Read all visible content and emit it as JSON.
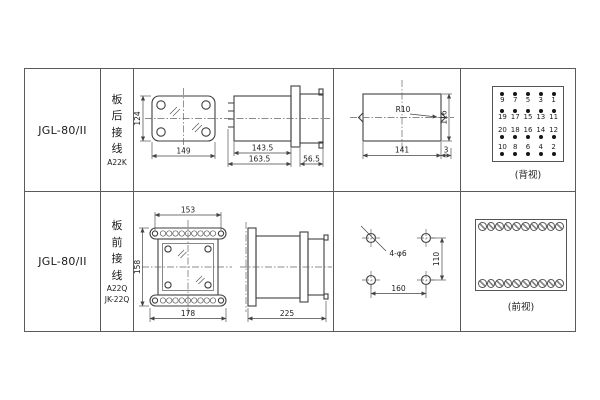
{
  "table": {
    "rows": [
      {
        "model": "JGL-80/II",
        "wiring_chars": "板后接线",
        "wiring_codes": [
          "A22K"
        ],
        "front_view": {
          "height_dim": "124",
          "width_dim": "149"
        },
        "side_view": {
          "body_dim": "143.5",
          "total_dim": "163.5",
          "rear_dim": "56.5"
        },
        "cutout_view": {
          "radius_label": "R10",
          "width_dim": "141",
          "height_dim": "116",
          "edge_dim": "3"
        },
        "rear_terminals": {
          "caption": "(背视)",
          "rows": [
            {
              "dot_position": "above",
              "numbers": [
                "9",
                "7",
                "5",
                "3",
                "1"
              ]
            },
            {
              "dot_position": "above",
              "numbers": [
                "19",
                "17",
                "15",
                "13",
                "11"
              ]
            },
            {
              "dot_position": "below",
              "numbers": [
                "20",
                "18",
                "16",
                "14",
                "12"
              ]
            },
            {
              "dot_position": "below",
              "numbers": [
                "10",
                "8",
                "6",
                "4",
                "2"
              ]
            }
          ]
        }
      },
      {
        "model": "JGL-80/II",
        "wiring_chars": "板前接线",
        "wiring_codes": [
          "A22Q",
          "JK-22Q"
        ],
        "front_view": {
          "top_dim": "153",
          "height_dim": "158",
          "bottom_dim": "178"
        },
        "side_view": {
          "total_dim": "225"
        },
        "holes_view": {
          "label": "4-φ6",
          "height_dim": "110",
          "width_dim": "160"
        },
        "front_terminals": {
          "caption": "(前视)",
          "rows": 2,
          "per_row": 10
        }
      }
    ]
  }
}
